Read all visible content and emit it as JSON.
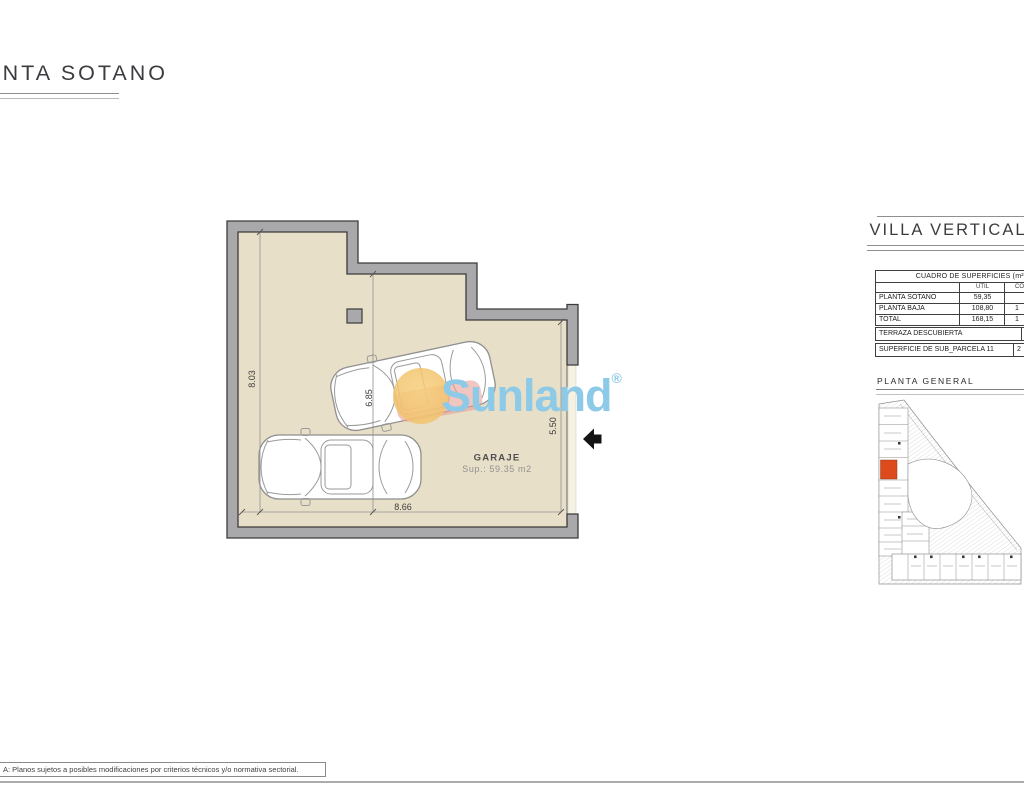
{
  "sheet": {
    "title": "PLANTA SOTANO",
    "footer_note": "A: Planos sujetos a posibles modificaciones por criterios técnicos y/o normativa sectorial."
  },
  "plan": {
    "room": {
      "name": "GARAJE",
      "area": "Sup.: 59.35 m2"
    },
    "dimensions": {
      "left": "8.03",
      "inner": "6.85",
      "right": "5.50",
      "bottom": "8.66"
    }
  },
  "watermark": {
    "brand": "Sunland",
    "registered": "®"
  },
  "panel": {
    "project_title": "VILLA VERTICAL",
    "surfaces_table": {
      "title": "CUADRO DE SUPERFICIES (m²)",
      "columns": {
        "util": "UTIL",
        "construida": "CONSTRUIDA"
      },
      "rows": [
        {
          "label": "PLANTA SOTANO",
          "util": "59,35",
          "construida": ""
        },
        {
          "label": "PLANTA BAJA",
          "util": "108,80",
          "construida": "1"
        },
        {
          "label": "TOTAL",
          "util": "168,15",
          "construida": "1"
        }
      ],
      "terraza": {
        "label": "TERRAZA DESCUBIERTA",
        "value": ""
      },
      "parcela": {
        "label": "SUPERFICIE DE SUB_PARCELA 11",
        "value": "2"
      }
    },
    "map_title": "PLANTA GENERAL"
  },
  "colors": {
    "floor": "#e8dfc8",
    "wall": "#a9a9ab",
    "outline": "#3b3b3b",
    "highlight_plot": "#dd4b1c",
    "watermark_blue": "#8ccae8",
    "watermark_orange": "#f2c36d",
    "watermark_pink": "#e79e96"
  }
}
